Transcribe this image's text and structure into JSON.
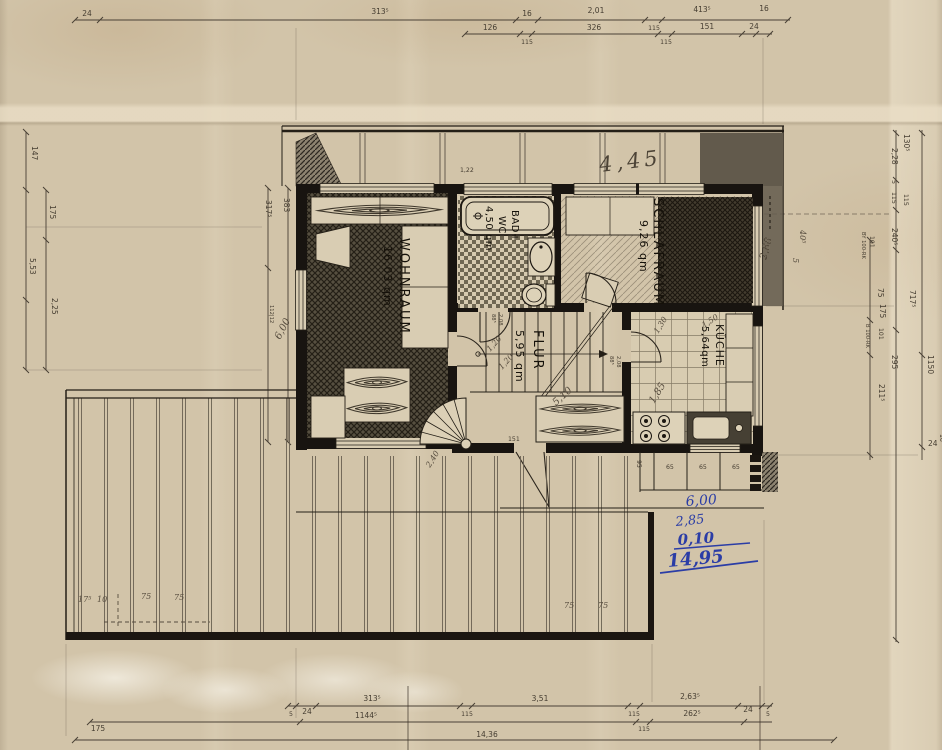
{
  "rooms": {
    "wohnraum": {
      "name": "WOHNRAUM",
      "area": "16,03 qm"
    },
    "bad": {
      "name1": "BAD+",
      "name2": "WC",
      "area": "4,50 qm"
    },
    "schlafraum": {
      "name": "SCHLAFRAUM",
      "area": "9,26 qm"
    },
    "kueche": {
      "name": "KÜCHE",
      "area": "5,64qm"
    },
    "flur": {
      "name": "FLUR",
      "area": "5,95 qm"
    }
  },
  "dims": {
    "top1": [
      "24",
      "313⁵",
      "16",
      "2,01",
      "115",
      "413⁵",
      "16"
    ],
    "top2": [
      "126",
      "115",
      "326",
      "115",
      "151",
      "24"
    ],
    "bottom1": [
      "5",
      "24",
      "313⁵",
      "115",
      "3,51",
      "115",
      "2,63⁵",
      "24",
      "5"
    ],
    "bottom2": [
      "175",
      "1144⁵",
      "115",
      "262⁵"
    ],
    "total_width": "14,36",
    "left": [
      "147",
      "175",
      "5,53",
      "2,25"
    ],
    "inner_left": [
      "317⁵",
      "383",
      "112|12"
    ],
    "right": [
      "130⁵",
      "2,28",
      "5",
      "115",
      "115",
      "240⁵",
      "101",
      "BY 100-RK",
      "75",
      "717⁵",
      "175",
      "101",
      "B 100-RK",
      "295",
      "211⁵",
      "1150",
      "24",
      "16"
    ],
    "doors": [
      "88⁵",
      "2,08",
      "88⁵",
      "2,08"
    ],
    "steps": [
      "65",
      "65",
      "65",
      "95",
      "151"
    ],
    "window": "1,22"
  },
  "handwritten": {
    "pencil": {
      "roof_width": "4,45",
      "left_height": "6,00",
      "right_height": "2,88",
      "right_small": "40⁵",
      "right_tick": "5",
      "flur_a": "1,20",
      "flur_b": "1,20",
      "flur_c": "5,10",
      "spiral": "2,40",
      "kueche_a": "1,30",
      "kueche_b": "1,50",
      "kueche_c": "1,85",
      "deck": [
        "17⁵",
        "10",
        "75",
        "75",
        "75",
        "75"
      ]
    },
    "blue_sum": {
      "line1": "6,00",
      "line2": "2,85",
      "line3": "0,10",
      "total": "14,95"
    }
  }
}
